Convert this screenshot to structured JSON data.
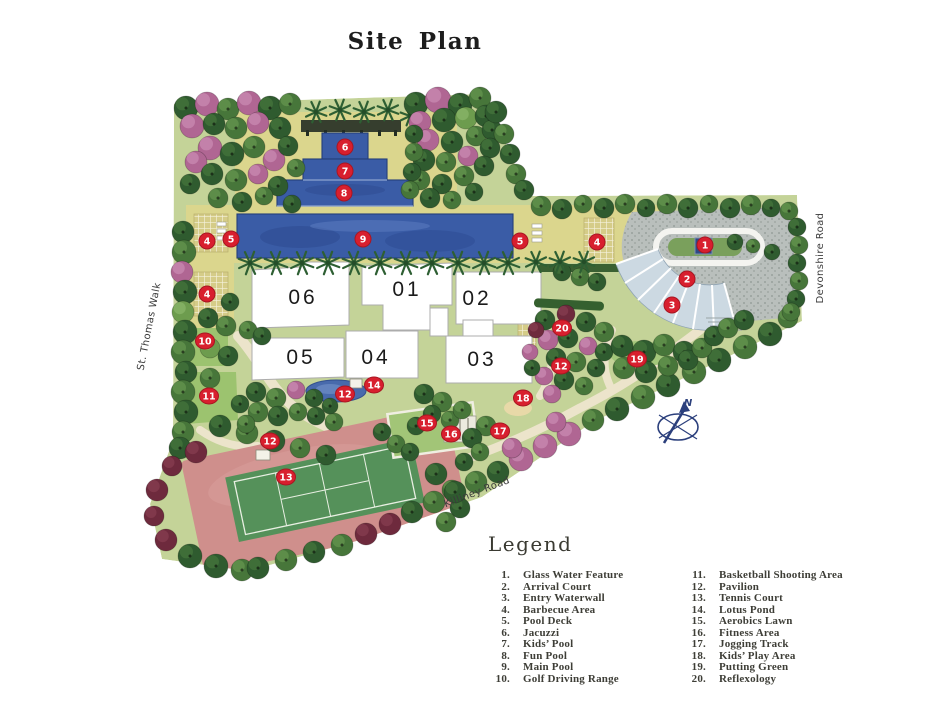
{
  "title": "Site Plan",
  "colors": {
    "marker": "#d81f2e",
    "marker_edge": "#a81622",
    "pool": "#3a5ca6",
    "deck": "#dbd68d",
    "canopy": "#ccd9e2",
    "clay": "#cf8f8c",
    "court": "#55915a",
    "legendtext": "#3e3e37",
    "compass": "#2b3f7c"
  },
  "map": {
    "compass": {
      "label": "N"
    },
    "roads": [
      {
        "name": "St. Thomas Walk",
        "x": 152,
        "y": 327,
        "angle": -79
      },
      {
        "name": "Devonshire Road",
        "x": 823,
        "y": 258,
        "angle": -90
      },
      {
        "name": "Killiney Road",
        "x": 478,
        "y": 495,
        "angle": -21
      }
    ],
    "buildings": [
      {
        "label": "06",
        "x": 303,
        "y": 297
      },
      {
        "label": "01",
        "x": 407,
        "y": 289
      },
      {
        "label": "02",
        "x": 477,
        "y": 298
      },
      {
        "label": "05",
        "x": 301,
        "y": 357
      },
      {
        "label": "04",
        "x": 376,
        "y": 357
      },
      {
        "label": "03",
        "x": 482,
        "y": 359
      }
    ],
    "markers": [
      {
        "n": 1,
        "x": 705,
        "y": 245
      },
      {
        "n": 2,
        "x": 687,
        "y": 279
      },
      {
        "n": 3,
        "x": 672,
        "y": 305
      },
      {
        "n": 4,
        "x": 207,
        "y": 241
      },
      {
        "n": 4,
        "x": 207,
        "y": 294
      },
      {
        "n": 4,
        "x": 597,
        "y": 242
      },
      {
        "n": 5,
        "x": 231,
        "y": 239
      },
      {
        "n": 5,
        "x": 520,
        "y": 241
      },
      {
        "n": 6,
        "x": 345,
        "y": 147
      },
      {
        "n": 7,
        "x": 345,
        "y": 171
      },
      {
        "n": 8,
        "x": 344,
        "y": 193
      },
      {
        "n": 9,
        "x": 363,
        "y": 239
      },
      {
        "n": 10,
        "x": 205,
        "y": 341
      },
      {
        "n": 11,
        "x": 209,
        "y": 396
      },
      {
        "n": 12,
        "x": 345,
        "y": 394
      },
      {
        "n": 12,
        "x": 270,
        "y": 441
      },
      {
        "n": 12,
        "x": 561,
        "y": 366
      },
      {
        "n": 13,
        "x": 286,
        "y": 477
      },
      {
        "n": 14,
        "x": 374,
        "y": 385
      },
      {
        "n": 15,
        "x": 427,
        "y": 423
      },
      {
        "n": 16,
        "x": 451,
        "y": 434
      },
      {
        "n": 17,
        "x": 500,
        "y": 431
      },
      {
        "n": 18,
        "x": 523,
        "y": 398
      },
      {
        "n": 19,
        "x": 637,
        "y": 359
      },
      {
        "n": 20,
        "x": 562,
        "y": 328
      }
    ]
  },
  "legend": {
    "heading": "Legend",
    "items": [
      {
        "num": "1.",
        "label": "Glass Water Feature"
      },
      {
        "num": "2.",
        "label": "Arrival Court"
      },
      {
        "num": "3.",
        "label": "Entry Waterwall"
      },
      {
        "num": "4.",
        "label": "Barbecue Area"
      },
      {
        "num": "5.",
        "label": "Pool Deck"
      },
      {
        "num": "6.",
        "label": "Jacuzzi"
      },
      {
        "num": "7.",
        "label": "Kids’ Pool"
      },
      {
        "num": "8.",
        "label": "Fun Pool"
      },
      {
        "num": "9.",
        "label": "Main Pool"
      },
      {
        "num": "10.",
        "label": "Golf Driving Range"
      },
      {
        "num": "11.",
        "label": "Basketball Shooting Area"
      },
      {
        "num": "12.",
        "label": "Pavilion"
      },
      {
        "num": "13.",
        "label": "Tennis Court"
      },
      {
        "num": "14.",
        "label": "Lotus Pond"
      },
      {
        "num": "15.",
        "label": "Aerobics Lawn"
      },
      {
        "num": "16.",
        "label": "Fitness Area"
      },
      {
        "num": "17.",
        "label": "Jogging Track"
      },
      {
        "num": "18.",
        "label": "Kids’ Play Area"
      },
      {
        "num": "19.",
        "label": "Putting Green"
      },
      {
        "num": "20.",
        "label": "Reflexology"
      }
    ]
  }
}
